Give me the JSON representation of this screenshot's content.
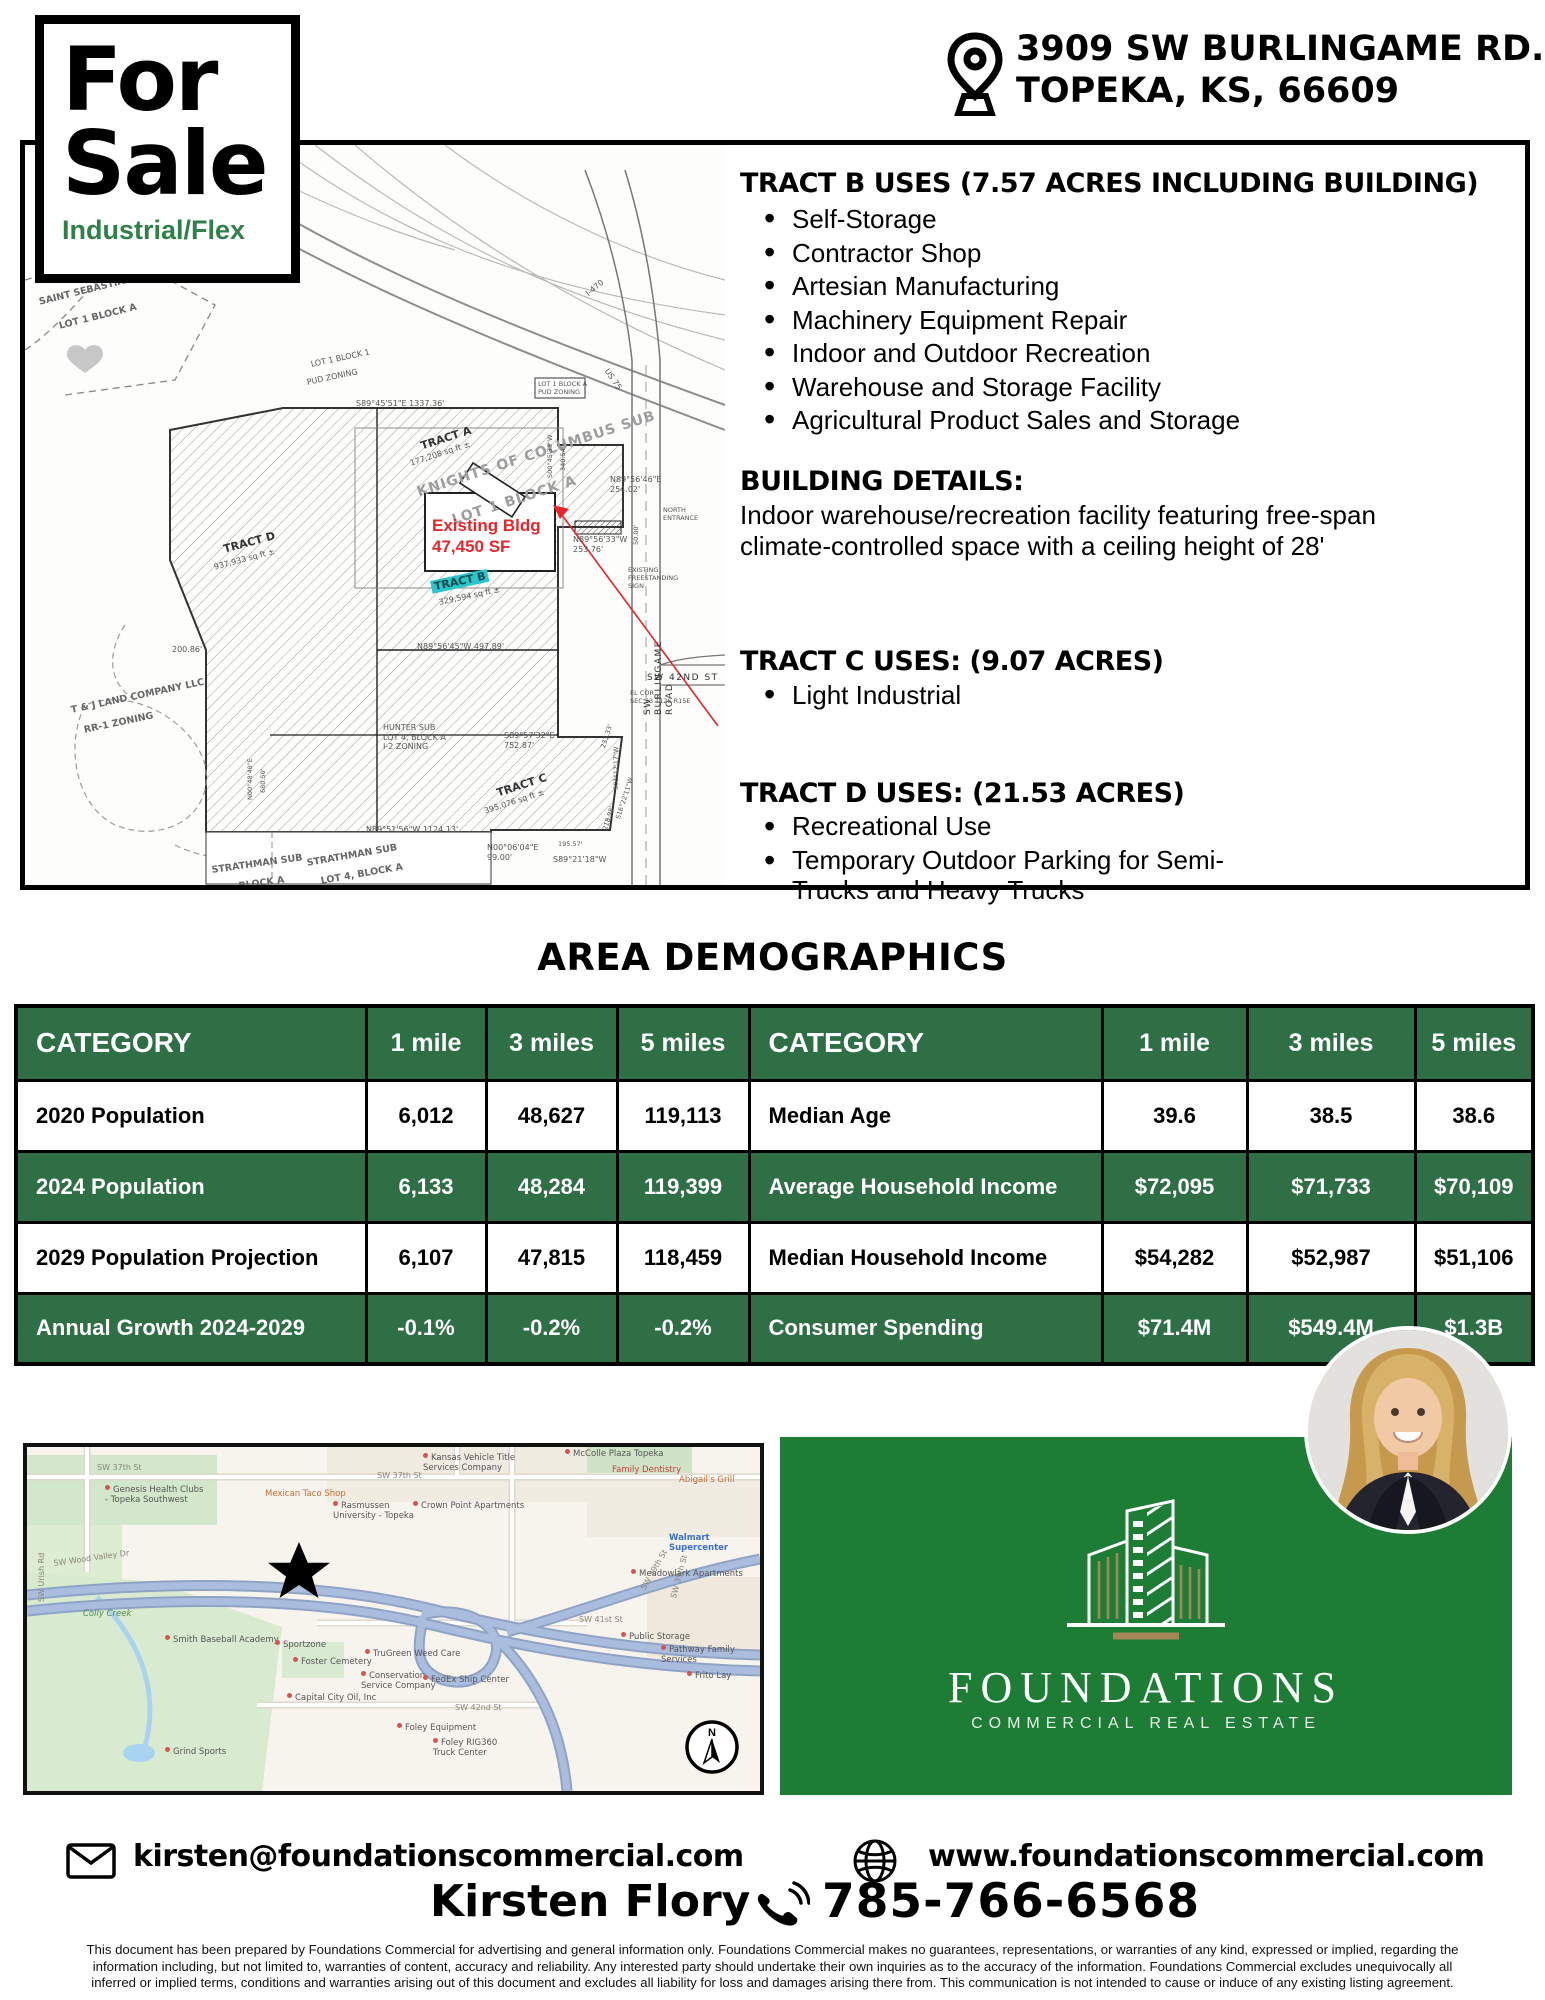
{
  "header": {
    "sale_word_1": "For",
    "sale_word_2": "Sale",
    "property_type": "Industrial/Flex",
    "address_line_1": "3909 SW BURLINGAME RD.",
    "address_line_2": "TOPEKA, KS, 66609"
  },
  "listing": {
    "tract_b_heading": "TRACT B USES (7.57 ACRES INCLUDING BUILDING)",
    "tract_b_uses": [
      "Self-Storage",
      "Contractor Shop",
      "Artesian Manufacturing",
      "Machinery Equipment Repair",
      "Indoor and Outdoor Recreation",
      "Warehouse and Storage Facility",
      "Agricultural Product Sales and Storage"
    ],
    "building_details_heading": "BUILDING DETAILS:",
    "building_details_body": "Indoor warehouse/recreation facility featuring free-span climate-controlled space with a ceiling height of 28'",
    "tract_c_heading": "TRACT C USES: (9.07 ACRES)",
    "tract_c_uses": [
      "Light Industrial"
    ],
    "tract_d_heading": "TRACT D USES: (21.53 ACRES)",
    "tract_d_uses": [
      "Recreational Use",
      "Temporary Outdoor Parking for Semi-Trucks and Heavy Trucks"
    ]
  },
  "plat": {
    "labels": [
      "SAINT SEBASTIAN SPORTS SUB",
      "LOT 1 BLOCK A",
      "LOT 1 BLOCK 1",
      "PUD ZONING",
      "I-470",
      "S89°45'51\"E    1337.36'",
      "TRACT A",
      "177,208 sq ft ±",
      "KNIGHTS OF COLUMBUS SUB",
      "LOT 1 BLOCK A",
      "N89°56'46\"E\n254.02'",
      "NORTH\nENTRANCE",
      "N89°56'33\"W\n253.76'",
      "50.00'",
      "EXISTING\nFREESTANDING\nSIGN",
      "SW BURLINGAME ROAD",
      "Existing Bldg\n47,450 SF",
      "TRACT B",
      "329,594 sq ft ±",
      "N89°56'45\"W    497.89'",
      "TRACT D",
      "937,933 sq ft ±",
      "200.86'",
      "T & J LAND COMPANY LLC",
      "RR-1 ZONING",
      "N00°48'48\"E",
      "680.50'",
      "S89°57'32\"E\n752.87'",
      "TRACT C",
      "395,076 sq ft ±",
      "N89°51'56\"W   1124.13'",
      "N00°06'04\"E\n99.00'",
      "S89°21'18\"W",
      "195.57'",
      "218.98'",
      "S16°22'11\"W",
      "S01°12'17\"W",
      "233.33'",
      "S00°45'33\"W",
      "340.54'",
      "STRATHMAN SUB",
      "BLOCK A",
      "STRATHMAN SUB",
      "LOT 4, BLOCK A",
      "HUNTER SUB\nLOT 4, BLOCK A\nI-2 ZONING",
      "SW 42ND ST",
      "EL COR\nSEC 23 T12S R15E",
      "US 75",
      "LOT 1 BLOCK A\nPUD ZONING"
    ]
  },
  "demographics": {
    "title": "AREA DEMOGRAPHICS",
    "header": [
      "CATEGORY",
      "1 mile",
      "3 miles",
      "5 miles",
      "CATEGORY",
      "1 mile",
      "3 miles",
      "5 miles"
    ],
    "rows": [
      [
        "2020 Population",
        "6,012",
        "48,627",
        "119,113",
        "Median Age",
        "39.6",
        "38.5",
        "38.6"
      ],
      [
        "2024 Population",
        "6,133",
        "48,284",
        "119,399",
        "Average Household Income",
        "$72,095",
        "$71,733",
        "$70,109"
      ],
      [
        "2029 Population Projection",
        "6,107",
        "47,815",
        "118,459",
        "Median Household Income",
        "$54,282",
        "$52,987",
        "$51,106"
      ],
      [
        "Annual Growth 2024-2029",
        "-0.1%",
        "-0.2%",
        "-0.2%",
        "Consumer Spending",
        "$71.4M",
        "$549.4M",
        "$1.3B"
      ]
    ]
  },
  "map": {
    "labels": [
      "SW 37th St",
      "Kansas Vehicle Title\nServices Company",
      "McColle Plaza Topeka",
      "SW 37th St",
      "Family Dentistry",
      "Abigail's Grill",
      "Genesis Health Clubs\n- Topeka Southwest",
      "Mexican Taco Shop",
      "Rasmussen\nUniversity - Topeka",
      "Crown Point Apartments",
      "Walmart Supercenter",
      "Meadowlark Apartments",
      "SW Wood Valley Dr",
      "Colly Creek",
      "Smith Baseball Academy",
      "Sportzone",
      "Foster Cemetery",
      "Public Storage",
      "SW 41st St",
      "Pathway Family Services",
      "Frito Lay",
      "TruGreen Weed Care",
      "Conservation\nService Company",
      "FedEx Ship Center",
      "Capital City Oil, Inc",
      "SW 42nd St",
      "Foley Equipment",
      "Foley RIG360\nTruck Center",
      "Grind Sports",
      "SW 39th St",
      "SW 39th St",
      "SW Urish Rd"
    ],
    "compass_label": "N"
  },
  "brand": {
    "name": "FOUNDATIONS",
    "tagline": "COMMERCIAL REAL ESTATE"
  },
  "contact": {
    "email": "kirsten@foundationscommercial.com",
    "website": "www.foundationscommercial.com",
    "agent_name": "Kirsten Flory",
    "phone": "785-766-6568"
  },
  "disclaimer": [
    "This document has been prepared by Foundations Commercial for advertising and general information only.  Foundations Commercial makes no guarantees, representations, or warranties of any kind, expressed or implied, regarding the",
    "information including, but not limited to, warranties of content, accuracy and reliability.  Any interested party should undertake their own inquiries as to the accuracy of the information.  Foundations Commercial excludes unequivocally all",
    "inferred or implied terms, conditions and warranties arising out of this document and excludes all liability for loss and damages arising there from.  This communication is not intended to cause or induce of any existing listing agreement."
  ],
  "colors": {
    "brand_green": "#1E7D35",
    "table_green": "#2E6F46",
    "type_green": "#2F8049",
    "accent_tan": "#A38757",
    "highlight_teal": "#2CC5CB",
    "callout_red": "#E8252B"
  }
}
